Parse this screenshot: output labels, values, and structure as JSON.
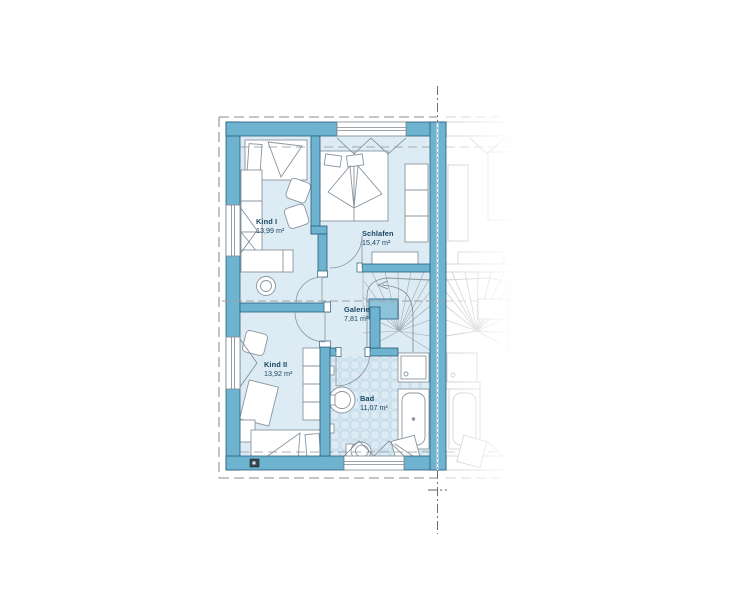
{
  "plan": {
    "type": "floor-plan",
    "language": "de",
    "rooms": [
      {
        "id": "kind1",
        "name": "Kind I",
        "area": "13,99 m²"
      },
      {
        "id": "schlafen",
        "name": "Schlafen",
        "area": "15,47 m²"
      },
      {
        "id": "galerie",
        "name": "Galerie",
        "area": "7,81 m²"
      },
      {
        "id": "kind2",
        "name": "Kind II",
        "area": "13,92 m²"
      },
      {
        "id": "bad",
        "name": "Bad",
        "area": "11,07 m²"
      }
    ],
    "fixtures": [
      "single-bed",
      "double-bed",
      "wardrobe",
      "desk",
      "chair",
      "stairs",
      "shower",
      "bathtub",
      "sink",
      "toilet",
      "laundry-basket"
    ],
    "colors": {
      "wall_fill": "#6eb4d1",
      "wall_stroke": "#2a5d77",
      "floor_fill": "#dcebf4",
      "stair_well": "#8cc3da",
      "tile_line": "#b7d3e1",
      "furniture_stroke": "#8a959e",
      "ghost_line": "#c9cdd0",
      "dash_line": "#8a8f93",
      "label_text": "#1c4660"
    }
  }
}
